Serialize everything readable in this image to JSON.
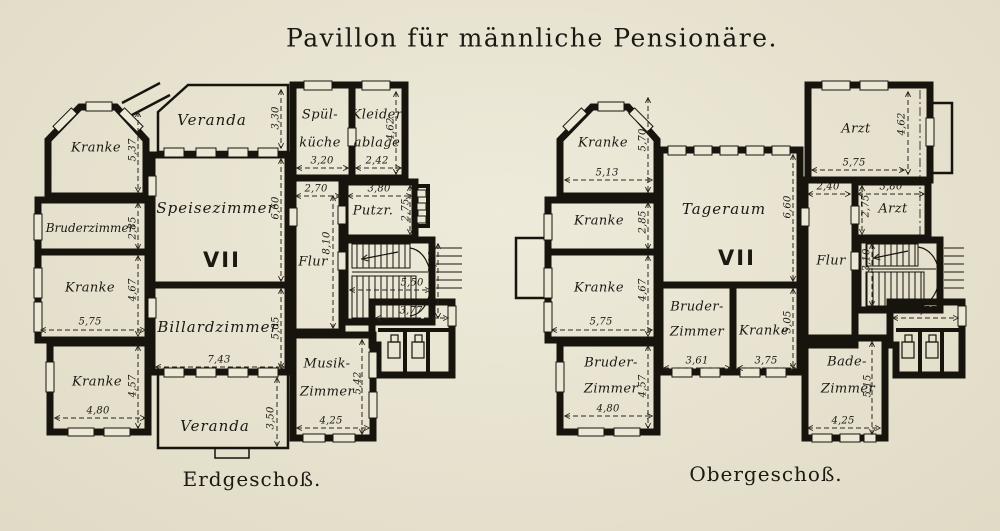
{
  "title": "Pavillon für männliche Pensionäre.",
  "colors": {
    "paper": "#e9e4d0",
    "ink": "#17130d"
  },
  "eg": {
    "caption": "Erdgeschoß.",
    "numeral": "VII",
    "kranke_nw": {
      "label": "Kranke",
      "h": "5,37"
    },
    "veranda_n": {
      "label": "Veranda",
      "h": "3,30"
    },
    "spuelkueche": {
      "l1": "Spül-",
      "l2": "küche",
      "w": "3,20"
    },
    "kleiderablage": {
      "l1": "Kleider",
      "l2": "ablage",
      "w": "2,42",
      "h": "4,62"
    },
    "bruderzimmer": {
      "label": "Bruderzimmer",
      "h": "2,85"
    },
    "speisezimmer": {
      "label": "Speisezimmer",
      "h": "6,60"
    },
    "flur": {
      "label": "Flur",
      "w": "2,70",
      "h": "8,10"
    },
    "putzraum": {
      "label": "Putzr.",
      "w": "3,80",
      "h": "2,75"
    },
    "treppe": {
      "w": "5,50",
      "h": "3,10"
    },
    "kranke_w": {
      "label": "Kranke",
      "h": "4,67",
      "w": "5,75"
    },
    "billardzimmer": {
      "label": "Billardzimmer",
      "w": "7,43",
      "h": "5,05"
    },
    "abort": {
      "w": "3,77"
    },
    "kranke_sw": {
      "label": "Kranke",
      "h": "4,57",
      "w": "4,80"
    },
    "musikzimmer": {
      "l1": "Musik-",
      "l2": "Zimmer",
      "h": "5,42",
      "w": "4,25"
    },
    "veranda_s": {
      "label": "Veranda",
      "h": "3,50"
    }
  },
  "og": {
    "caption": "Obergeschoß.",
    "numeral": "VII",
    "kranke_nw": {
      "label": "Kranke",
      "h": "5,70",
      "w": "5,13"
    },
    "kranke_w2": {
      "label": "Kranke",
      "h": "2,85"
    },
    "tageraum": {
      "label": "Tageraum",
      "h": "6,60"
    },
    "arzt_n": {
      "label": "Arzt",
      "h": "4,62",
      "w": "5,75"
    },
    "arzt_s": {
      "label": "Arzt",
      "w": "3,80",
      "h": "2,75"
    },
    "flur": {
      "label": "Flur",
      "w": "2,40"
    },
    "treppe": {
      "h": "3,10"
    },
    "kranke_w3": {
      "label": "Kranke",
      "h": "4,67",
      "w": "5,75"
    },
    "bruderzimmer_m": {
      "l1": "Bruder-",
      "l2": "Zimmer",
      "w": "3,61"
    },
    "kranke_m": {
      "label": "Kranke",
      "h": "5,05",
      "w": "3,75"
    },
    "bruderzimmer_sw": {
      "l1": "Bruder-",
      "l2": "Zimmer",
      "h": "4,57",
      "w": "4,80"
    },
    "abort": {
      "w": "3,77"
    },
    "badezimmer": {
      "l1": "Bade-",
      "l2": "Zimmer",
      "h": "5,15",
      "w": "4,25"
    }
  }
}
